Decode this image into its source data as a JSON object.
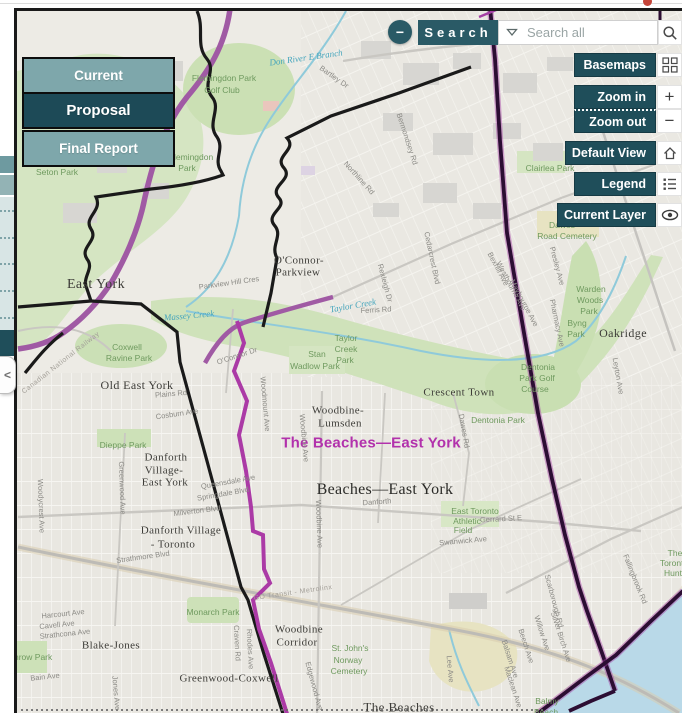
{
  "search": {
    "collapse_icon": "−",
    "label": "Search",
    "placeholder": "Search all"
  },
  "left_panel": {
    "collapse_icon": "<"
  },
  "view_buttons": {
    "items": [
      {
        "label": "Current",
        "active": false
      },
      {
        "label": "Proposal",
        "active": true
      },
      {
        "label": "Final Report",
        "active": false
      }
    ]
  },
  "map_controls": {
    "items": [
      {
        "label": "Basemaps",
        "icon": "basemaps-grid"
      },
      {
        "label": "Zoom in",
        "icon": "plus"
      },
      {
        "label": "Zoom out",
        "icon": "minus"
      },
      {
        "label": "Default View",
        "icon": "home"
      },
      {
        "label": "Legend",
        "icon": "legend-list"
      },
      {
        "label": "Current Layer",
        "icon": "eye"
      }
    ]
  },
  "colors": {
    "teal_dark": "#1f4e5a",
    "teal_medium": "#2a5a66",
    "teal_light": "#7ea7ab",
    "ward_magenta": "#b231ac",
    "proposal_line": "#ab3aa6",
    "boundary_dark_purple": "#2c0e33",
    "road_purple": "#a05aa4",
    "park_green": "#cfe2ba",
    "water_blue": "#b9d9e8"
  },
  "map": {
    "highlighted_ward": "The Beaches—East York",
    "labels": [
      {
        "t": "East York",
        "x": 95,
        "y": 284,
        "c": "nb",
        "s": 14
      },
      {
        "t": "Old East York",
        "x": 136,
        "y": 384,
        "c": "nb",
        "s": 12
      },
      {
        "t": "O'Connor-",
        "x": 298,
        "y": 260,
        "c": "nb"
      },
      {
        "t": "Parkview",
        "x": 297,
        "y": 272,
        "c": "nb"
      },
      {
        "t": "Woodbine-",
        "x": 337,
        "y": 410,
        "c": "nb"
      },
      {
        "t": "Lumsden",
        "x": 339,
        "y": 423,
        "c": "nb"
      },
      {
        "t": "Crescent Town",
        "x": 458,
        "y": 392,
        "c": "nb"
      },
      {
        "t": "Danforth",
        "x": 165,
        "y": 457,
        "c": "nb"
      },
      {
        "t": "Village-",
        "x": 163,
        "y": 470,
        "c": "nb"
      },
      {
        "t": "East York",
        "x": 164,
        "y": 482,
        "c": "nb"
      },
      {
        "t": "Danforth Village",
        "x": 180,
        "y": 530,
        "c": "nb"
      },
      {
        "t": "- Toronto",
        "x": 172,
        "y": 544,
        "c": "nb"
      },
      {
        "t": "Blake-Jones",
        "x": 110,
        "y": 645,
        "c": "nb"
      },
      {
        "t": "Greenwood-Coxwell",
        "x": 228,
        "y": 678,
        "c": "nb"
      },
      {
        "t": "Woodbine",
        "x": 298,
        "y": 629,
        "c": "nb"
      },
      {
        "t": "Corridor",
        "x": 296,
        "y": 642,
        "c": "nb"
      },
      {
        "t": "The Beaches",
        "x": 398,
        "y": 706,
        "c": "nb",
        "s": 13
      },
      {
        "t": "Oakridge",
        "x": 622,
        "y": 332,
        "c": "nb",
        "s": 12
      },
      {
        "t": "Beaches—East York",
        "x": 384,
        "y": 489,
        "c": "big"
      },
      {
        "t": "The Beaches—East York",
        "x": 370,
        "y": 442,
        "c": "ward"
      },
      {
        "t": "Flemingdon Park",
        "x": 223,
        "y": 77,
        "c": "park"
      },
      {
        "t": "Golf Club",
        "x": 221,
        "y": 89,
        "c": "park"
      },
      {
        "t": "Flemingdon",
        "x": 190,
        "y": 156,
        "c": "park"
      },
      {
        "t": "Park",
        "x": 186,
        "y": 167,
        "c": "park"
      },
      {
        "t": "Seton Park",
        "x": 56,
        "y": 171,
        "c": "park"
      },
      {
        "t": "Coxwell",
        "x": 126,
        "y": 346,
        "c": "park"
      },
      {
        "t": "Ravine Park",
        "x": 128,
        "y": 357,
        "c": "park"
      },
      {
        "t": "Taylor",
        "x": 345,
        "y": 337,
        "c": "park"
      },
      {
        "t": "Creek",
        "x": 345,
        "y": 348,
        "c": "park"
      },
      {
        "t": "Park",
        "x": 344,
        "y": 359,
        "c": "park"
      },
      {
        "t": "Stan",
        "x": 316,
        "y": 353,
        "c": "park"
      },
      {
        "t": "Wadlow Park",
        "x": 314,
        "y": 365,
        "c": "park"
      },
      {
        "t": "Dieppe Park",
        "x": 122,
        "y": 444,
        "c": "park"
      },
      {
        "t": "Monarch Park",
        "x": 212,
        "y": 611,
        "c": "park"
      },
      {
        "t": "Withrow Park",
        "x": 26,
        "y": 656,
        "c": "park"
      },
      {
        "t": "Dentonia",
        "x": 537,
        "y": 366,
        "c": "park"
      },
      {
        "t": "Park Golf",
        "x": 536,
        "y": 377,
        "c": "park"
      },
      {
        "t": "Course",
        "x": 534,
        "y": 388,
        "c": "park"
      },
      {
        "t": "Dentonia Park",
        "x": 497,
        "y": 419,
        "c": "park"
      },
      {
        "t": "Warden",
        "x": 590,
        "y": 288,
        "c": "park"
      },
      {
        "t": "Woods",
        "x": 589,
        "y": 299,
        "c": "park"
      },
      {
        "t": "Park",
        "x": 588,
        "y": 310,
        "c": "park"
      },
      {
        "t": "Byng",
        "x": 576,
        "y": 322,
        "c": "park"
      },
      {
        "t": "Park",
        "x": 575,
        "y": 333,
        "c": "park"
      },
      {
        "t": "Clairlea Park",
        "x": 549,
        "y": 167,
        "c": "park"
      },
      {
        "t": "Dawes",
        "x": 561,
        "y": 224,
        "c": "park"
      },
      {
        "t": "Road Cemetery",
        "x": 566,
        "y": 235,
        "c": "park"
      },
      {
        "t": "St. John's",
        "x": 349,
        "y": 647,
        "c": "park"
      },
      {
        "t": "Norway",
        "x": 347,
        "y": 659,
        "c": "park"
      },
      {
        "t": "Cemetery",
        "x": 348,
        "y": 670,
        "c": "park"
      },
      {
        "t": "East Toronto",
        "x": 474,
        "y": 510,
        "c": "park"
      },
      {
        "t": "Athletic",
        "x": 466,
        "y": 520,
        "c": "park"
      },
      {
        "t": "Field",
        "x": 462,
        "y": 529,
        "c": "park"
      },
      {
        "t": "Balmy",
        "x": 546,
        "y": 700,
        "c": "park"
      },
      {
        "t": "Beach",
        "x": 545,
        "y": 711,
        "c": "park"
      },
      {
        "t": "The",
        "x": 674,
        "y": 552,
        "c": "park"
      },
      {
        "t": "Toronto",
        "x": 673,
        "y": 562,
        "c": "park"
      },
      {
        "t": "Hunt",
        "x": 672,
        "y": 572,
        "c": "park"
      },
      {
        "t": "Don River E Branch",
        "x": 305,
        "y": 57,
        "c": "creek",
        "r": -8
      },
      {
        "t": "Taylor Creek",
        "x": 352,
        "y": 305,
        "c": "creek",
        "r": -10
      },
      {
        "t": "Massey Creek",
        "x": 188,
        "y": 315,
        "c": "creek",
        "r": -5
      },
      {
        "t": "Parkview Hill Cres",
        "x": 228,
        "y": 282,
        "r": -8
      },
      {
        "t": "Ferris Rd",
        "x": 375,
        "y": 309,
        "r": -3
      },
      {
        "t": "Rexleigh Dr",
        "x": 384,
        "y": 282,
        "r": 75
      },
      {
        "t": "Cedarcrest Blvd",
        "x": 431,
        "y": 257,
        "r": 78
      },
      {
        "t": "O'Connor Dr",
        "x": 236,
        "y": 355,
        "r": -18
      },
      {
        "t": "Plains Rd",
        "x": 170,
        "y": 393,
        "r": -5
      },
      {
        "t": "Cosburn Ave",
        "x": 176,
        "y": 413,
        "r": -8
      },
      {
        "t": "Woodmount Ave",
        "x": 264,
        "y": 403,
        "r": 85
      },
      {
        "t": "Woodbine Ave",
        "x": 303,
        "y": 437,
        "r": 85
      },
      {
        "t": "Woodbine Ave",
        "x": 318,
        "y": 523,
        "r": 88
      },
      {
        "t": "Queensdale Ave",
        "x": 227,
        "y": 481,
        "r": -10
      },
      {
        "t": "Springdale Blvd",
        "x": 222,
        "y": 493,
        "r": -10
      },
      {
        "t": "Milverton Blvd",
        "x": 196,
        "y": 510,
        "r": -7
      },
      {
        "t": "Strathmore Blvd",
        "x": 142,
        "y": 556,
        "r": -8
      },
      {
        "t": "Danforth",
        "x": 376,
        "y": 501,
        "r": -4
      },
      {
        "t": "Greenwood Ave",
        "x": 121,
        "y": 487,
        "r": 88
      },
      {
        "t": "Woodycrest Ave",
        "x": 40,
        "y": 505,
        "r": 88
      },
      {
        "t": "Gerrard St E",
        "x": 500,
        "y": 518,
        "r": -3
      },
      {
        "t": "Swanwick Ave",
        "x": 462,
        "y": 540,
        "r": -5
      },
      {
        "t": "Dawes Rd",
        "x": 463,
        "y": 430,
        "r": 80
      },
      {
        "t": "Bartley Dr",
        "x": 333,
        "y": 76,
        "r": 35
      },
      {
        "t": "Bermondsey Rd",
        "x": 406,
        "y": 138,
        "r": 72
      },
      {
        "t": "Northline Rd",
        "x": 358,
        "y": 177,
        "r": 48
      },
      {
        "t": "Presley Ave",
        "x": 556,
        "y": 265,
        "r": 75
      },
      {
        "t": "Pharmacy Ave",
        "x": 556,
        "y": 322,
        "r": 78
      },
      {
        "t": "Bexhill Ave",
        "x": 497,
        "y": 268,
        "r": 62
      },
      {
        "t": "Westbourne Ave",
        "x": 510,
        "y": 285,
        "r": 62
      },
      {
        "t": "Maybourne Ave",
        "x": 523,
        "y": 302,
        "r": 62
      },
      {
        "t": "Leyton Ave",
        "x": 617,
        "y": 375,
        "r": 80
      },
      {
        "t": "Rhodes Ave",
        "x": 249,
        "y": 648,
        "r": 87
      },
      {
        "t": "Craven Rd",
        "x": 236,
        "y": 642,
        "r": 87
      },
      {
        "t": "Edgewood Ave",
        "x": 313,
        "y": 685,
        "r": 75
      },
      {
        "t": "Scarborough Rd",
        "x": 553,
        "y": 600,
        "r": 75
      },
      {
        "t": "Silver Birch Ave",
        "x": 560,
        "y": 636,
        "r": 72
      },
      {
        "t": "Willow Ave",
        "x": 541,
        "y": 632,
        "r": 72
      },
      {
        "t": "Beech Ave",
        "x": 525,
        "y": 645,
        "r": 72
      },
      {
        "t": "Balsam Ave",
        "x": 509,
        "y": 658,
        "r": 72
      },
      {
        "t": "Maclean Ave",
        "x": 512,
        "y": 686,
        "r": 72
      },
      {
        "t": "Lee Ave",
        "x": 449,
        "y": 668,
        "r": 85
      },
      {
        "t": "Fallingbrook Rd",
        "x": 634,
        "y": 578,
        "r": 68
      },
      {
        "t": "Harcourt Ave",
        "x": 62,
        "y": 613,
        "r": -6
      },
      {
        "t": "Cavell Ave",
        "x": 56,
        "y": 624,
        "r": -6
      },
      {
        "t": "Strathcona Ave",
        "x": 64,
        "y": 633,
        "r": -6
      },
      {
        "t": "Bain Ave",
        "x": 44,
        "y": 676,
        "r": -6
      },
      {
        "t": "Jones Ave",
        "x": 115,
        "y": 692,
        "r": 85
      },
      {
        "t": "GO Transit - Metrolinx",
        "x": 292,
        "y": 592,
        "r": -8,
        "c": "st2"
      },
      {
        "t": "Canadian National Railway",
        "x": 60,
        "y": 362,
        "r": -38,
        "c": "st2"
      }
    ]
  }
}
